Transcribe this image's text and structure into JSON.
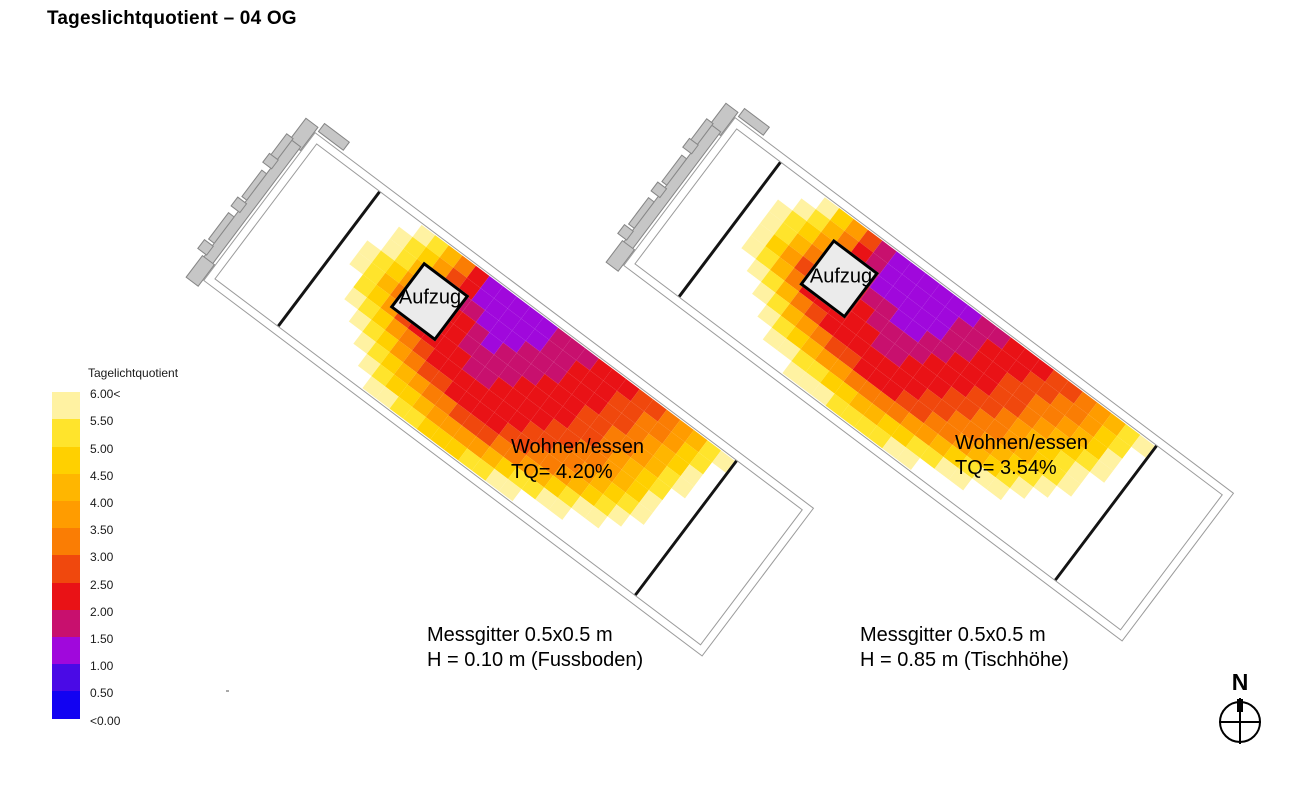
{
  "title": "Tageslichtquotient – 04 OG",
  "legend": {
    "title": "Tagelichtquotient",
    "labels": [
      "6.00<",
      "5.50",
      "5.00",
      "4.50",
      "4.00",
      "3.50",
      "3.00",
      "2.50",
      "2.00",
      "1.50",
      "1.00",
      "0.50",
      "<0.00"
    ],
    "swatch_colors": [
      "#FFFFFF",
      "#FFF2A2",
      "#FFE42C",
      "#FFD000",
      "#FFB600",
      "#FF9C00",
      "#FA7D04",
      "#F0480D",
      "#E91216",
      "#C8106E",
      "#A008DC",
      "#4A0AE6",
      "#1202F2"
    ]
  },
  "chart_data": [
    {
      "type": "heatmap",
      "name": "left-plan",
      "aufzug_label": "Aufzug",
      "room_label": "Wohnen/essen",
      "tq_label": "TQ= 4.20%",
      "tq_value_percent": 4.2,
      "caption_line1": "Messgitter 0.5x0.5 m",
      "caption_line2": "H = 0.10 m (Fussboden)",
      "grid_size_m": "0.5x0.5",
      "measurement_height_m": 0.1,
      "cells": [
        "00012468AAAAA9998887765421",
        "00123578AAAAA9988877665320",
        "001246899AAA99988877654310",
        "0123588889A999888776654210",
        "01246888899998888776543200",
        "00235788889988887766543100",
        "00123567888888877665432100",
        "00012356778888776654321000",
        "00001234566777665432110000",
        "00000123345555432211000000",
        "00000011223332211000000000"
      ]
    },
    {
      "type": "heatmap",
      "name": "right-plan",
      "aufzug_label": "Aufzug",
      "room_label": "Wohnen/essen",
      "tq_label": "TQ= 3.54%",
      "tq_value_percent": 3.54,
      "caption_line1": "Messgitter 0.5x0.5 m",
      "caption_line2": "H = 0.85 m (Tischhöhe)",
      "grid_size_m": "0.5x0.5",
      "measurement_height_m": 0.85,
      "cells": [
        "00013579AAAAAA998887765421",
        "00124689AAAAA9988877665320",
        "01235799AAAAA9988776654310",
        "0124688899AA99888776543210",
        "01357888899998887765432100",
        "01246888889988877665432100",
        "00124678888888776654321000",
        "00012456778887766543210000",
        "00001234556666554321100000",
        "00000112233443322110000000",
        "00000001112222110000000000"
      ]
    }
  ],
  "value_encoding": {
    "0": ">6.00",
    "1": "5.50-6.00",
    "2": "5.00-5.50",
    "3": "4.50-5.00",
    "4": "4.00-4.50",
    "5": "3.50-4.00",
    "6": "3.00-3.50",
    "7": "2.50-3.00",
    "8": "2.00-2.50",
    "9": "1.50-2.00",
    "A": "1.00-1.50",
    "B": "0.50-1.00",
    "C": "<0.50"
  },
  "compass": {
    "label": "N"
  }
}
